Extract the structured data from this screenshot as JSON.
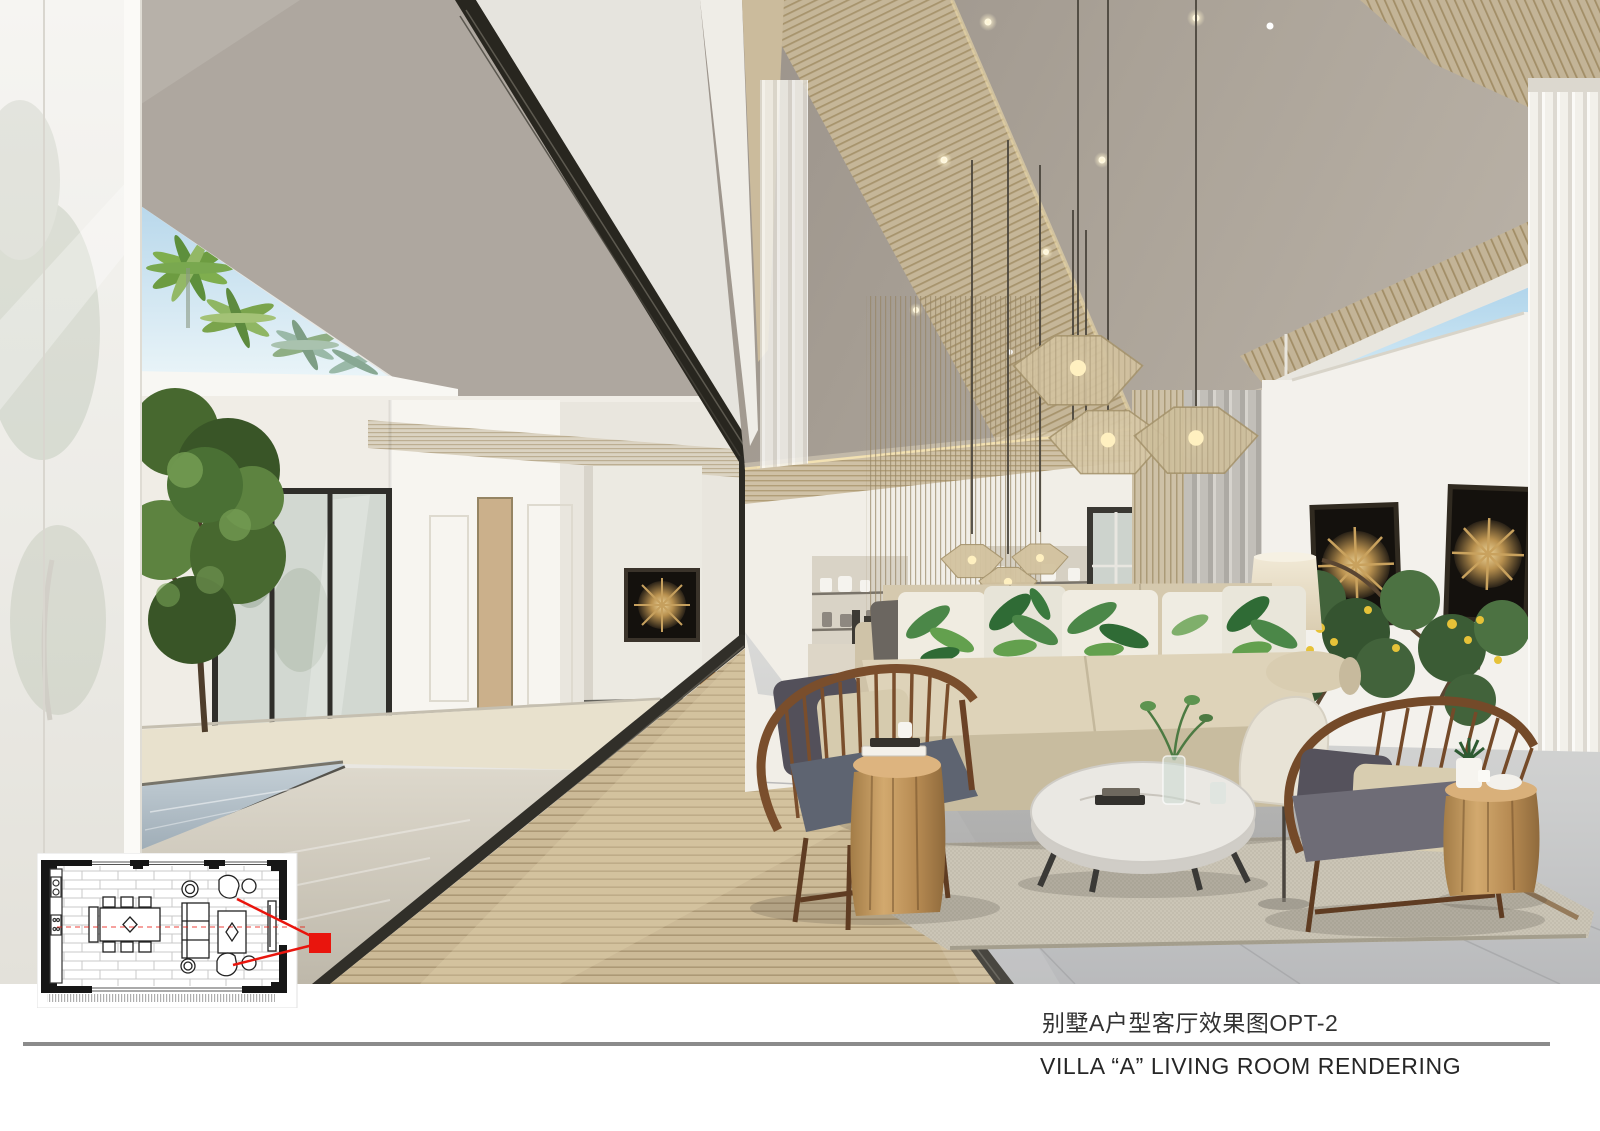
{
  "page": {
    "background": "#ffffff"
  },
  "captions": {
    "zh": "别墅A户型客厅效果图OPT-2",
    "en": "VILLA “A” LIVING ROOM RENDERING"
  },
  "divider": {
    "color": "#8b8b8b"
  },
  "floor_plan": {
    "view_marker_color": "#e9150d"
  }
}
